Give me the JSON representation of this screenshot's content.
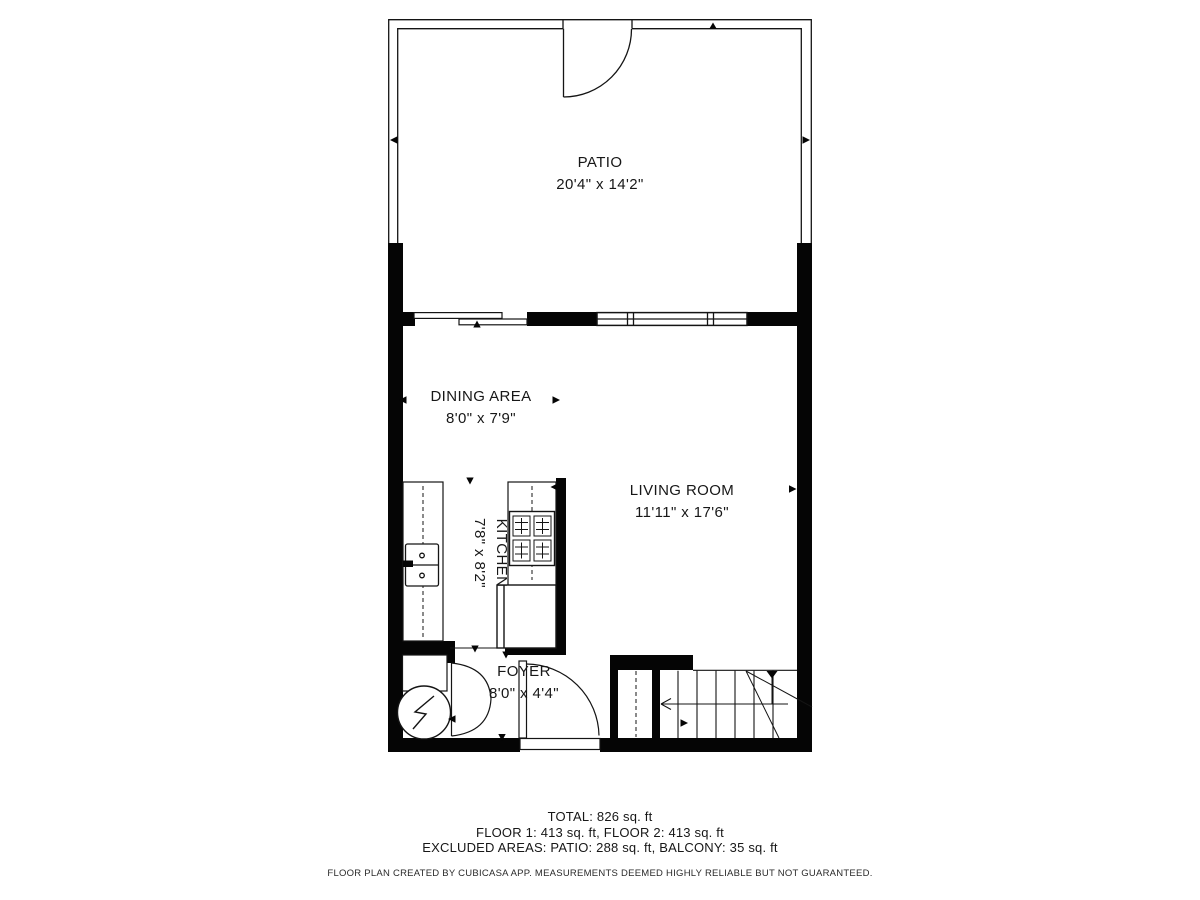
{
  "floor_plan": {
    "rooms": [
      {
        "name": "PATIO",
        "dimensions": "20'4\" x 14'2\""
      },
      {
        "name": "DINING AREA",
        "dimensions": "8'0\" x 7'9\""
      },
      {
        "name": "LIVING ROOM",
        "dimensions": "11'11\" x 17'6\""
      },
      {
        "name": "KITCHEN",
        "dimensions": "7'8\" x 8'2\""
      },
      {
        "name": "FOYER",
        "dimensions": "8'0\" x 4'4\""
      }
    ],
    "summary": {
      "total": "TOTAL: 826 sq. ft",
      "floors": "FLOOR 1: 413 sq. ft, FLOOR 2: 413 sq. ft",
      "excluded": "EXCLUDED AREAS: PATIO: 288 sq. ft, BALCONY: 35 sq. ft"
    },
    "disclaimer": "FLOOR PLAN CREATED BY CUBICASA APP. MEASUREMENTS DEEMED HIGHLY RELIABLE BUT NOT GUARANTEED.",
    "fixtures": [
      "patio-gate-door",
      "sliding-door",
      "window",
      "stove",
      "sink",
      "refrigerator",
      "water-heater",
      "closet-double-door",
      "entry-door",
      "staircase"
    ],
    "colors": {
      "wall": "#050505",
      "line": "#141414",
      "background": "#ffffff"
    }
  }
}
